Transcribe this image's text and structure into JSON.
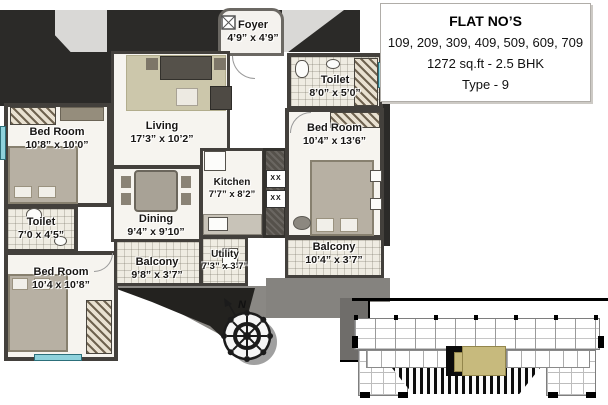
{
  "info_box": {
    "title": "FLAT NO’S",
    "flat_numbers": "109, 209, 309, 409, 509, 609, 709",
    "area_bhk": "1272 sq.ft - 2.5 BHK",
    "type": "Type - 9"
  },
  "plan": {
    "rooms": {
      "foyer": {
        "name": "Foyer",
        "dims": "4’9” x 4’9”"
      },
      "toilet_top": {
        "name": "Toilet",
        "dims": "8’0” x 5’0”"
      },
      "living": {
        "name": "Living",
        "dims": "17’3” x 10’2”"
      },
      "bedroom_left": {
        "name": "Bed Room",
        "dims": "10’8” x 10’0”"
      },
      "toilet_left": {
        "name": "Toilet",
        "dims": "7’0 x 4’5”"
      },
      "bedroom_bottom": {
        "name": "Bed Room",
        "dims": "10’4 x 10’8”"
      },
      "dining": {
        "name": "Dining",
        "dims": "9’4” x 9’10”"
      },
      "kitchen": {
        "name": "Kitchen",
        "dims": "7’7” x 8’2”"
      },
      "bedroom_right": {
        "name": "Bed Room",
        "dims": "10’4” x 13’6”"
      },
      "balcony_left": {
        "name": "Balcony",
        "dims": "9’8” x 3’7”"
      },
      "utility": {
        "name": "Utility",
        "dims": "7’3” x 3’7”"
      },
      "balcony_right": {
        "name": "Balcony",
        "dims": "10’4” x 3’7”"
      }
    },
    "compass": {
      "north_label": "N"
    },
    "shaft": {
      "marks": [
        "XX",
        "XX"
      ]
    }
  },
  "colors": {
    "wall": "#3c3a37",
    "floor": "#f6f4ef",
    "window": "#8fd2dc",
    "keyplan_highlight": "#c7ba7d"
  }
}
